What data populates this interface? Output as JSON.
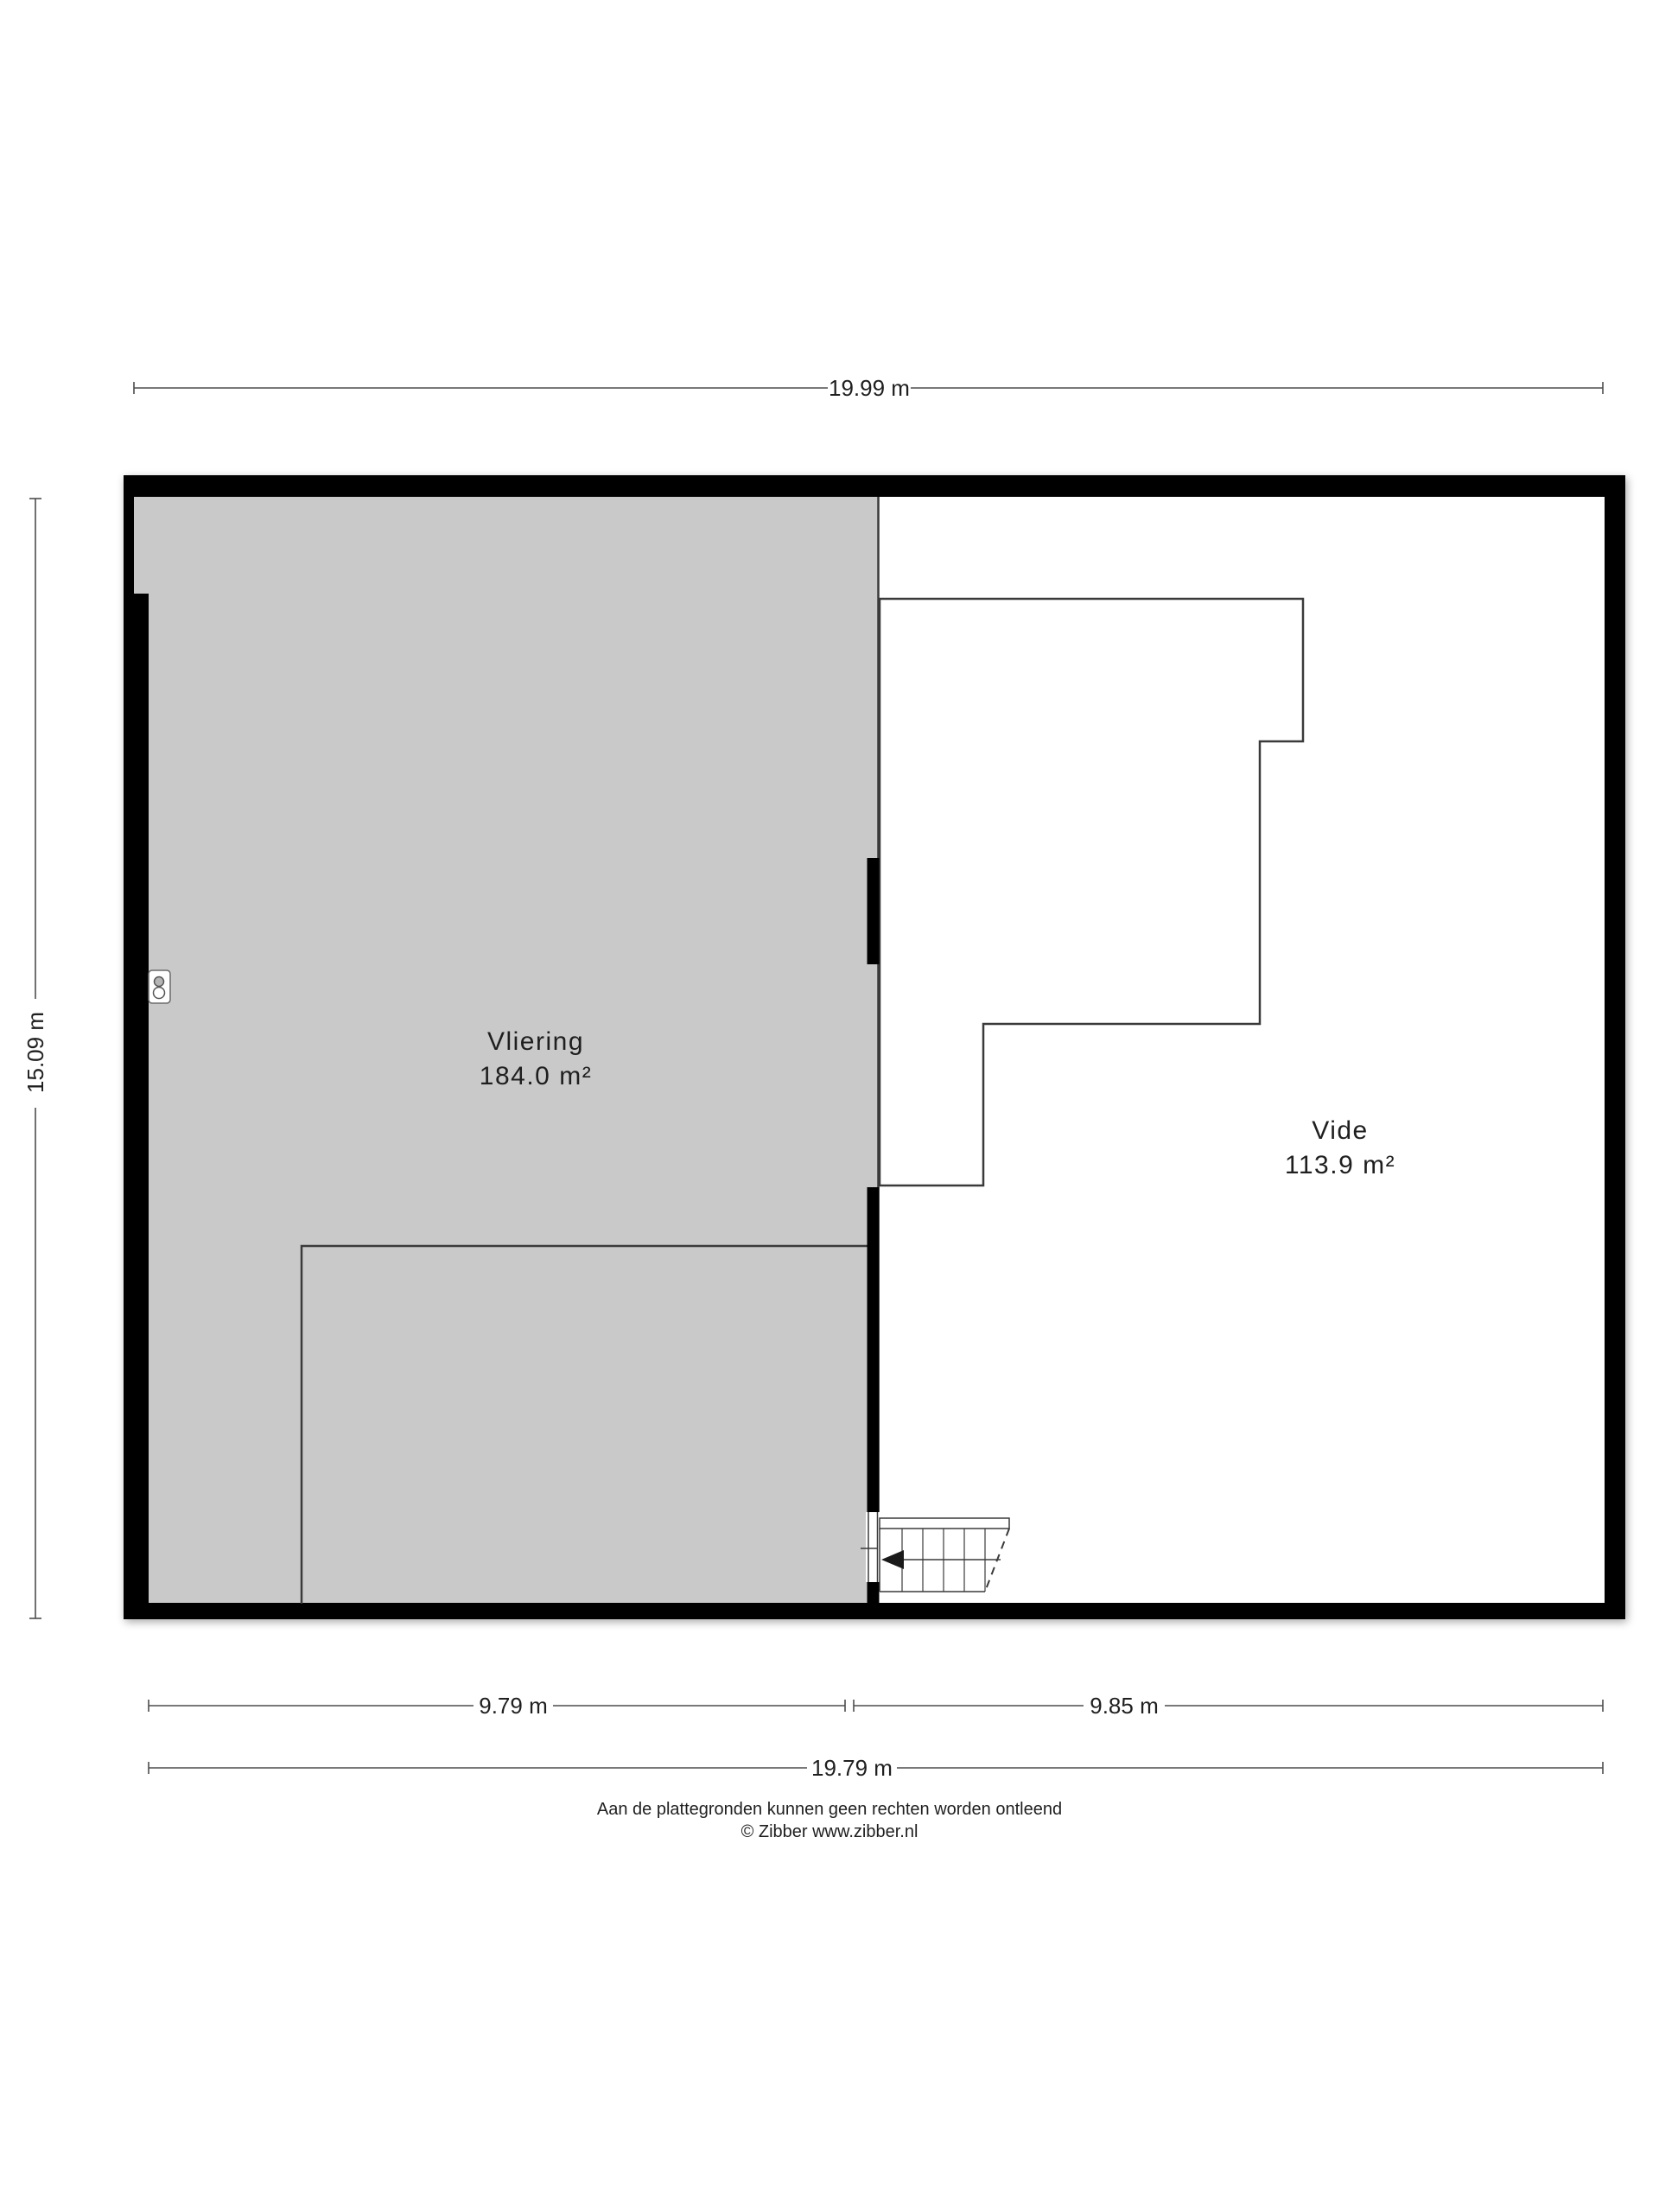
{
  "plan": {
    "type": "floor-plan",
    "rooms": [
      {
        "name": "Vliering",
        "area": "184.0 m²"
      },
      {
        "name": "Vide",
        "area": "113.9 m²"
      }
    ],
    "dimensions": {
      "top_total": "19.99 m",
      "left_total": "15.09 m",
      "bottom_left": "9.79 m",
      "bottom_right": "9.85 m",
      "bottom_total": "19.79 m"
    },
    "footer": {
      "disclaimer": "Aan de plattegronden kunnen geen rechten worden ontleend",
      "copyright": "© Zibber www.zibber.nl"
    },
    "icons": [
      {
        "name": "ventilation-unit-icon"
      }
    ],
    "colors": {
      "wall": "#000000",
      "room_fill": "#c9c9c9",
      "outline": "#3a3a3a",
      "dimension_line": "#4d4d4d",
      "text": "#1f1f1f",
      "background": "#ffffff"
    }
  }
}
